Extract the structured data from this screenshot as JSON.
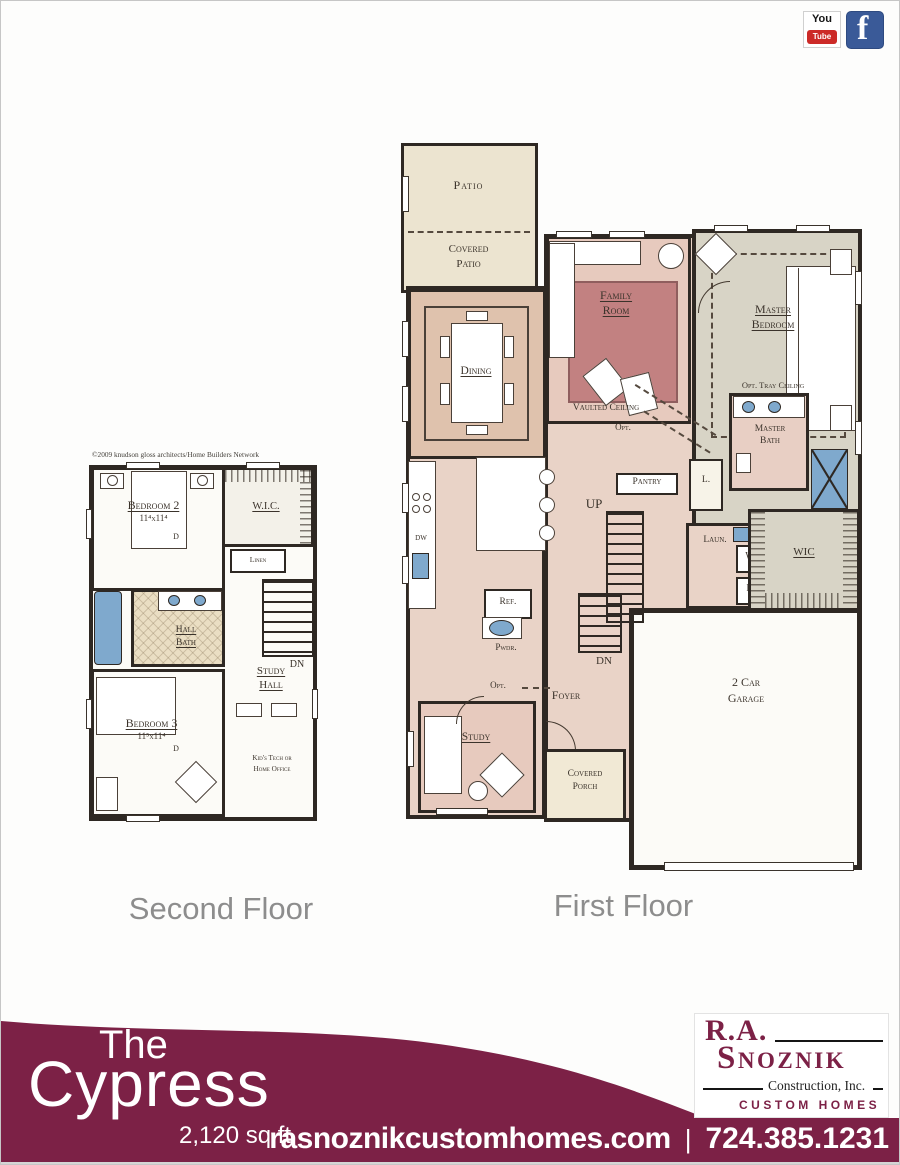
{
  "social": {
    "youtube_top": "You",
    "youtube_bottom": "Tube",
    "facebook": "f"
  },
  "captions": {
    "second_floor": "Second Floor",
    "first_floor": "First Floor"
  },
  "ff": {
    "patio": "Patio",
    "covered_patio_l1": "Covered",
    "covered_patio_l2": "Patio",
    "dining": "Dining",
    "family_l1": "Family",
    "family_l2": "Room",
    "vaulted": "Vaulted Ceiling",
    "opt_upper": "Opt.",
    "master_bed_l1": "Master",
    "master_bed_l2": "Bedroom",
    "tray": "Opt. Tray Ceiling",
    "pantry": "Pantry",
    "closet_l": "L.",
    "up": "UP",
    "master_bath_l1": "Master",
    "master_bath_l2": "Bath",
    "laun": "Laun.",
    "washer": "W",
    "dryer": "D",
    "wic": "WIC",
    "dw": "DW",
    "ref": "Ref.",
    "pwdr": "Pwdr.",
    "dn": "DN",
    "opt_lower": "Opt.",
    "foyer": "Foyer",
    "study": "Study",
    "porch_l1": "Covered",
    "porch_l2": "Porch",
    "garage_l1": "2 Car",
    "garage_l2": "Garage"
  },
  "sf": {
    "copyright": "©2009 knudson gloss architects/Home Builders Network",
    "bedroom2": "Bedroom 2",
    "bedroom2_dim": "11⁴x11⁴",
    "d2": "D",
    "wic": "W.I.C.",
    "linen": "Linen",
    "hall_bath_l1": "Hall",
    "hall_bath_l2": "Bath",
    "study_hall_l1": "Study",
    "study_hall_l2": "Hall",
    "dn": "DN",
    "bedroom3": "Bedroom 3",
    "bedroom3_dim": "11⁵x11⁴",
    "d3": "D",
    "kids_l1": "Kid's Tech or",
    "kids_l2": "Home Office"
  },
  "banner": {
    "the": "The",
    "name": "Cypress",
    "sqft": "2,120 sq ft",
    "website": "rasnoznikcustomhomes.com",
    "divider": "|",
    "phone": "724.385.1231"
  },
  "logo": {
    "initials": "R.A.",
    "surname": "Snoznik",
    "construction": "Construction, Inc.",
    "custom_homes": "CUSTOM HOMES"
  },
  "colors": {
    "maroon": "#7c2146",
    "wall_black": "#2e2823",
    "plan_tan": "#e9d3c7",
    "plan_beige": "#ece4d0",
    "plan_gray": "#d8d4c6",
    "rug_mauve": "#c28181",
    "fixture_blue": "#7fa9cd",
    "caption_gray": "#8d8d8d",
    "facebook_blue": "#3a5a98",
    "youtube_red": "#cc2a27"
  }
}
